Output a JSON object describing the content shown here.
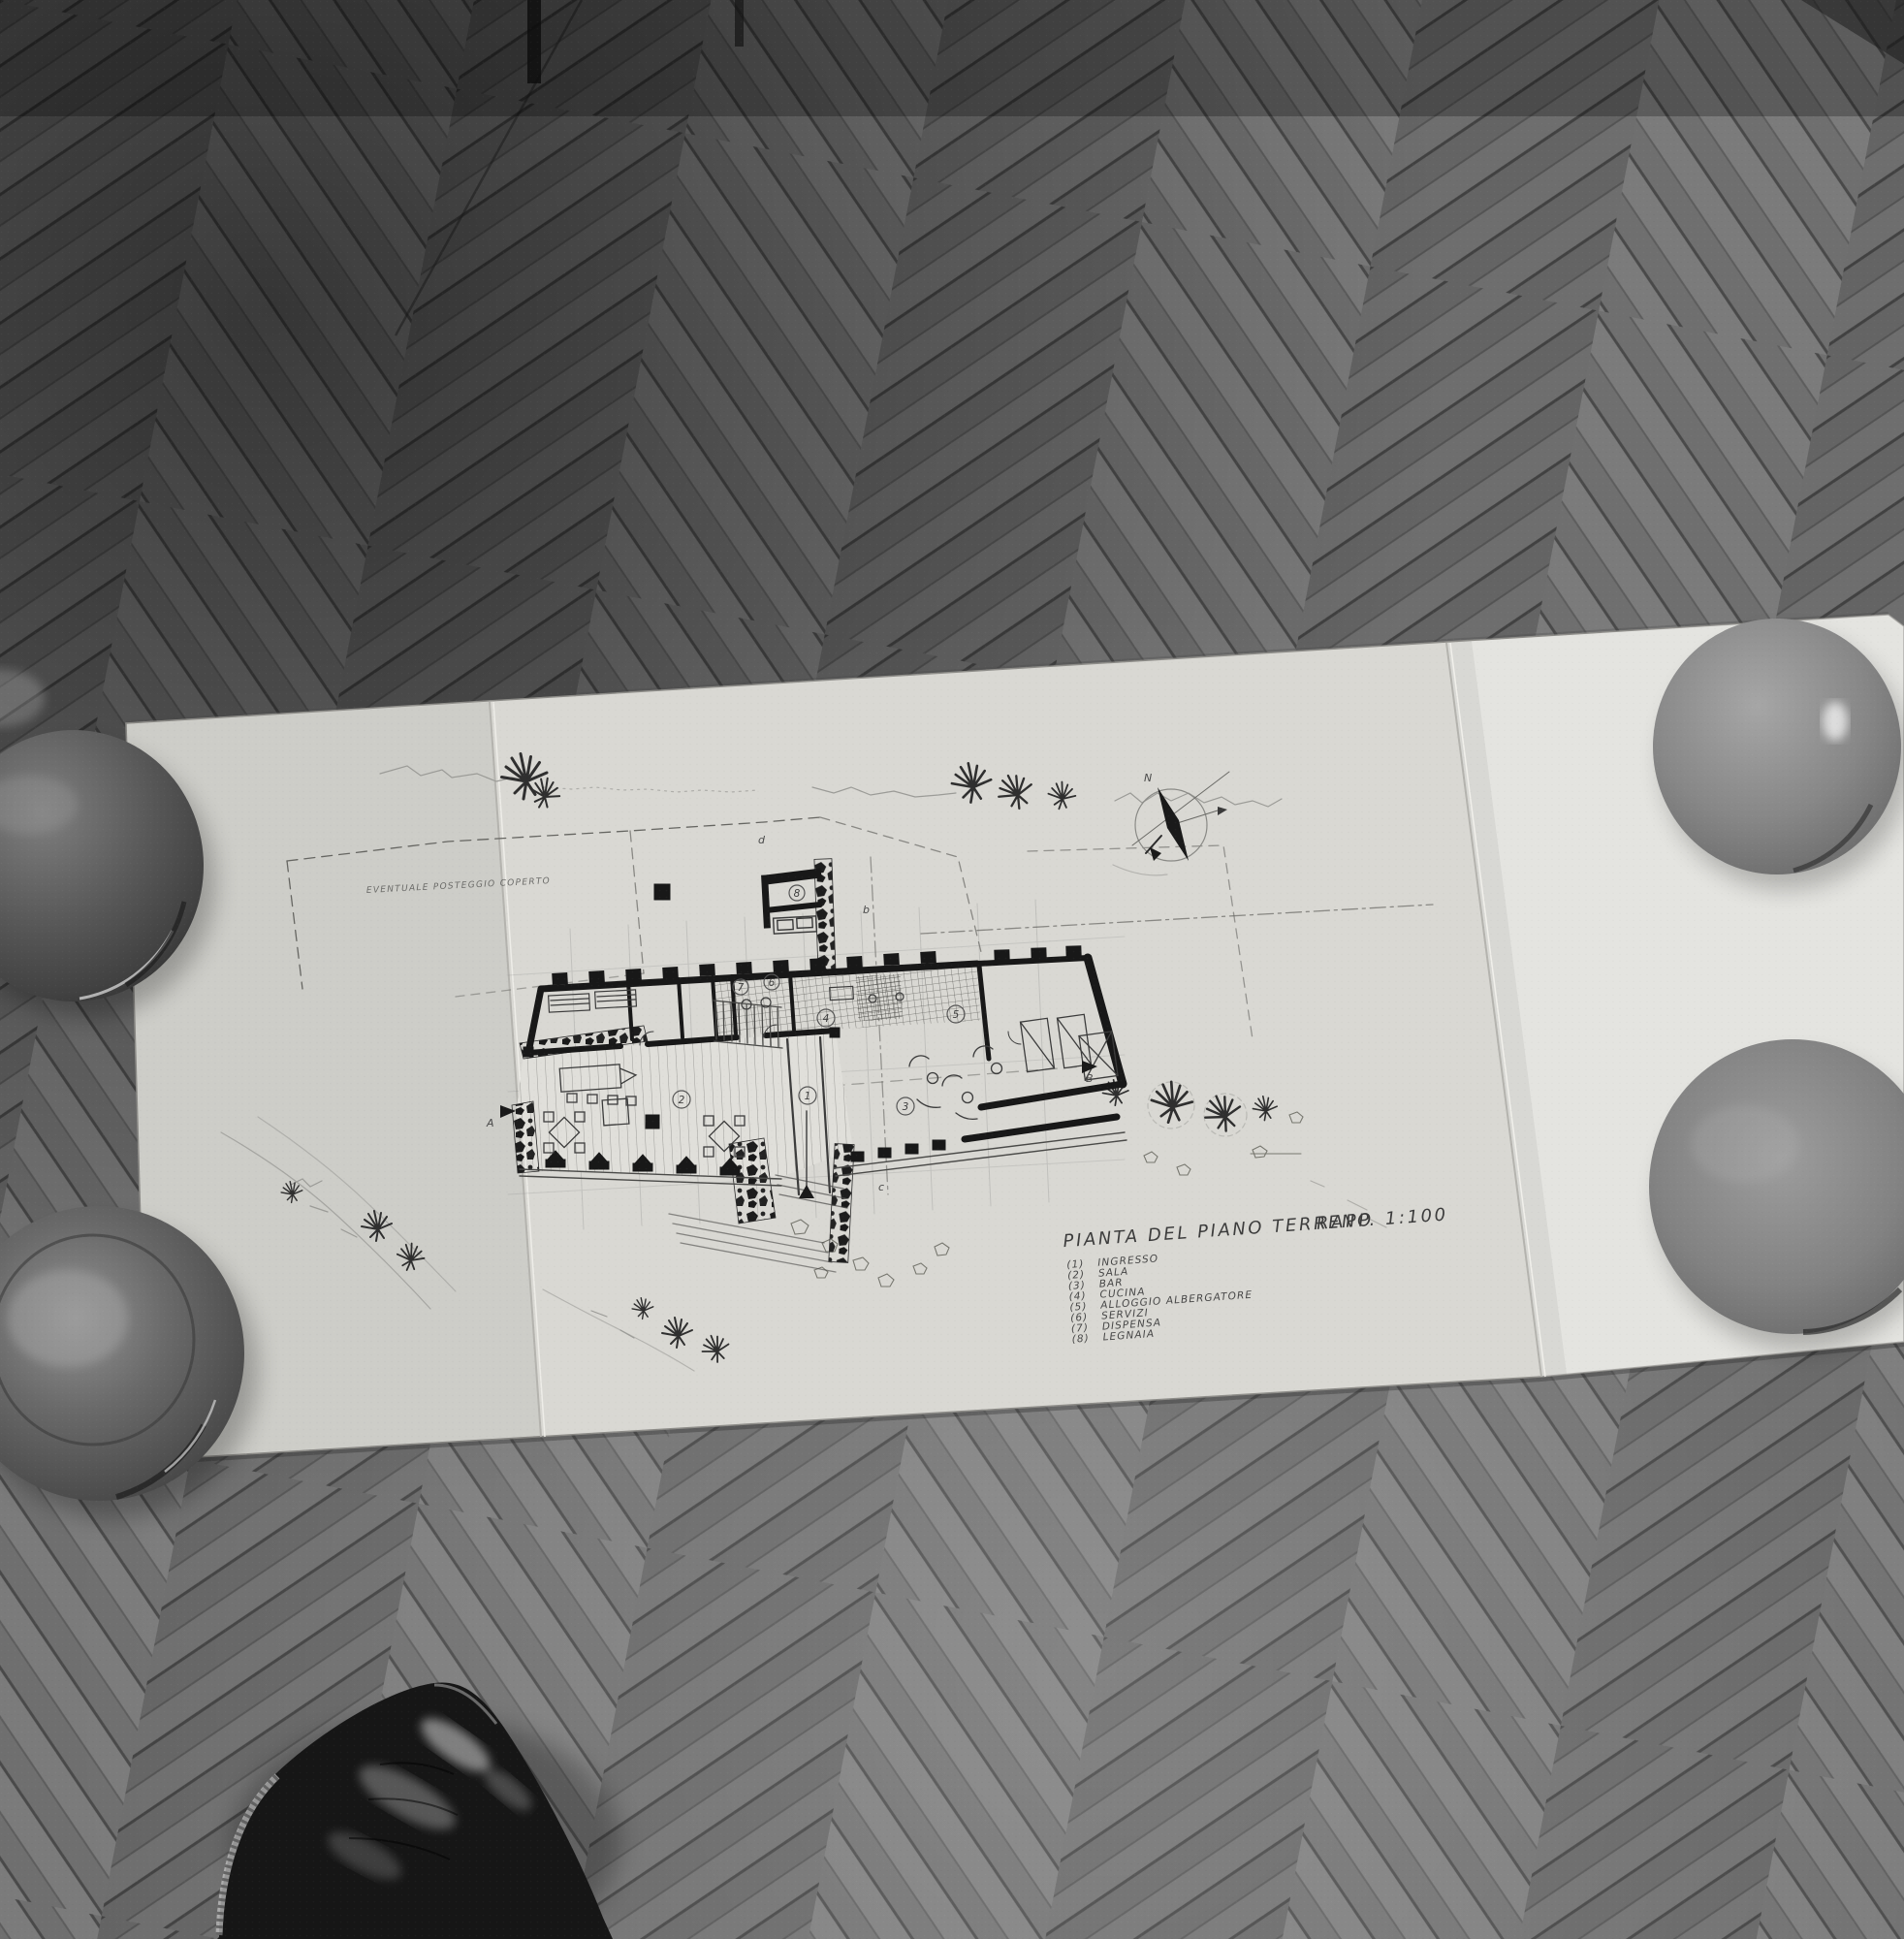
{
  "scene": {
    "type": "black-and-white photograph",
    "subject": "Unfolded architectural ground-floor plan lying on a herringbone parquet floor, weighted at its corners by four round ceramic bowls, with the photographer's black leather shoe entering the frame at bottom",
    "colors": {
      "floor_base": "#747474",
      "floor_dark": "#3a3a3a",
      "paper": "#d9d8d3",
      "paper_bright": "#e6e5e0",
      "ink": "#2f2f2f",
      "bowl_dark": "#474747",
      "bowl_light": "#8e8e8e",
      "shoe": "#161616"
    }
  },
  "plan": {
    "title": "PIANTA DEL PIANO TERRENO",
    "scale_label": "RAPP. 1:100",
    "legend": [
      {
        "num": "(1)",
        "label": "INGRESSO"
      },
      {
        "num": "(2)",
        "label": "SALA"
      },
      {
        "num": "(3)",
        "label": "BAR"
      },
      {
        "num": "(4)",
        "label": "CUCINA"
      },
      {
        "num": "(5)",
        "label": "ALLOGGIO ALBERGATORE"
      },
      {
        "num": "(6)",
        "label": "SERVIZI"
      },
      {
        "num": "(7)",
        "label": "DISPENSA"
      },
      {
        "num": "(8)",
        "label": "LEGNAIA"
      }
    ],
    "annotations": {
      "parking": "EVENTUALE POSTEGGIO COPERTO",
      "compass_north": "N",
      "section_left": "A",
      "section_right": "B",
      "section_letter_b": "b",
      "section_letter_c": "c",
      "section_letter_d": "d"
    },
    "room_numbers": [
      "1",
      "2",
      "3",
      "4",
      "5",
      "6",
      "7",
      "8"
    ]
  }
}
